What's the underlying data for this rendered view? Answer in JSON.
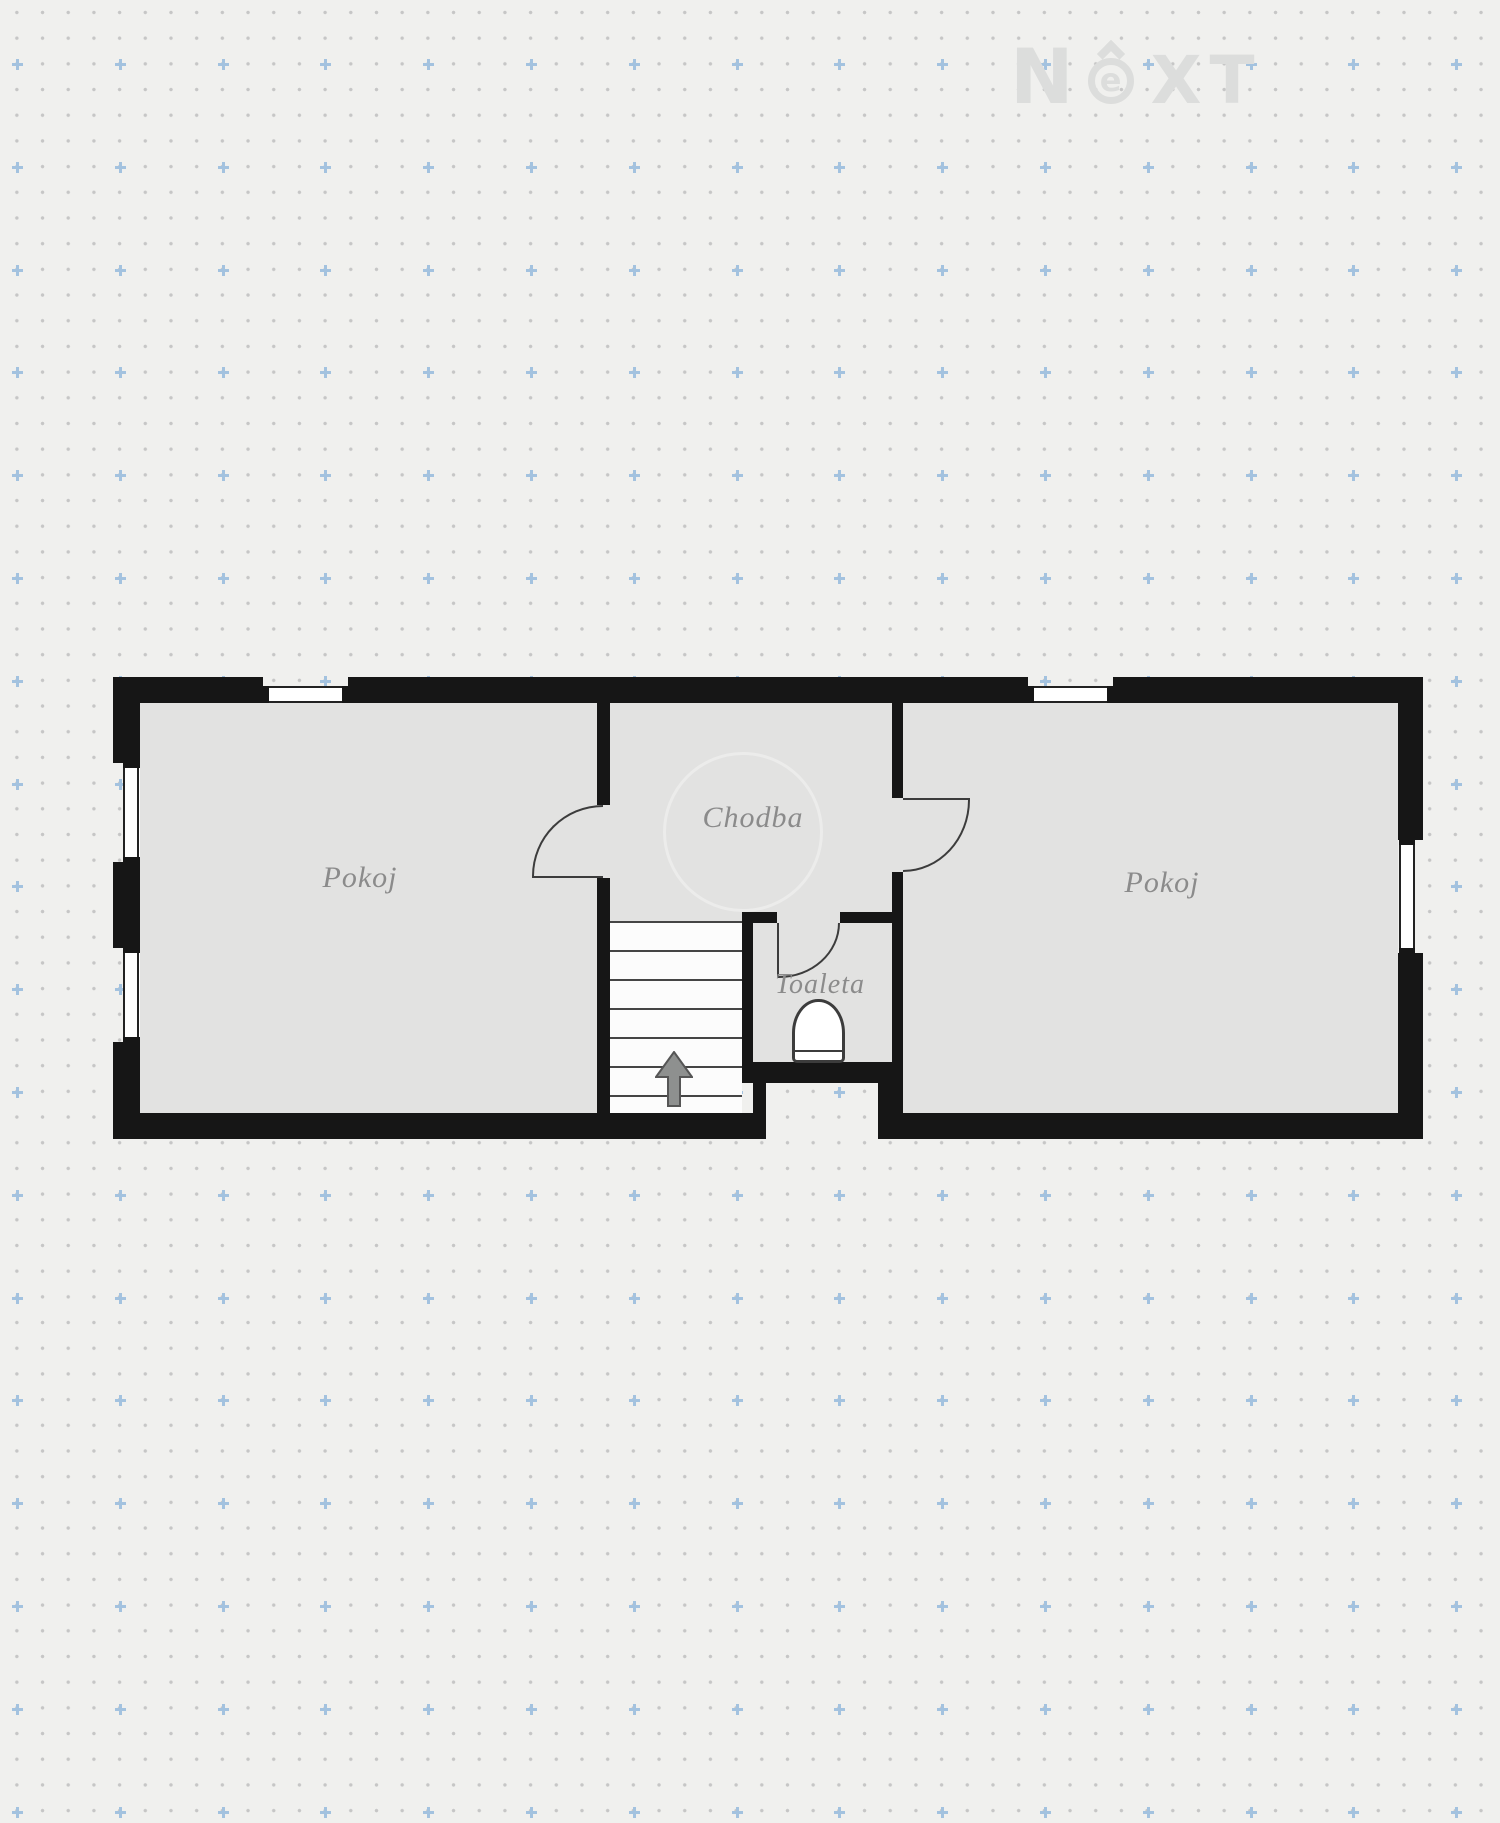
{
  "watermark": {
    "letters": [
      "N",
      "e",
      "X",
      "T"
    ]
  },
  "rooms": {
    "left": {
      "label": "Pokoj"
    },
    "hall": {
      "label": "Chodba"
    },
    "toilet": {
      "label": "Toaleta"
    },
    "right": {
      "label": "Pokoj"
    }
  },
  "colors": {
    "background": "#f0f0ee",
    "dot": "#c6c6c6",
    "accent_plus": "#a3c2df",
    "wall": "#161616",
    "floor": "#e2e2e1",
    "stairs": "#fcfcfc",
    "label": "#8b8b8b",
    "watermark": "#dcdddc",
    "line": "#3c3c3c"
  }
}
